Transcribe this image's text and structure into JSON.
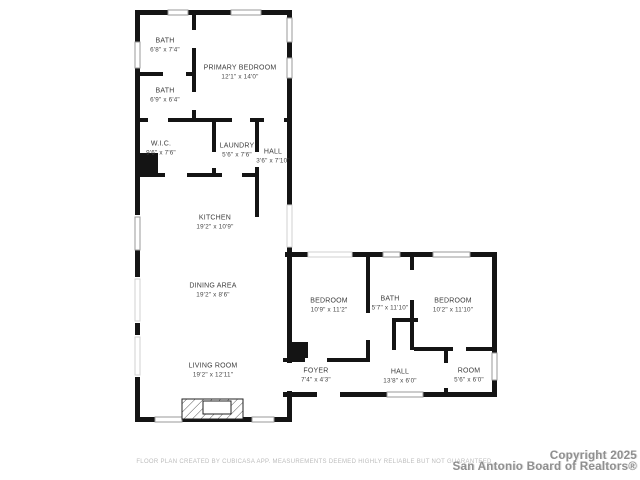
{
  "plan": {
    "source_app": "CubiCasa",
    "colors": {
      "wall": "#141414",
      "window_frame": "#9a9a9a",
      "room_label": "#3c3c3c",
      "disclaimer": "#bcbcbc",
      "copyright": "#8f8f8f",
      "background": "#ffffff"
    },
    "rooms": [
      {
        "id": "bath-upper",
        "name": "BATH",
        "dims": "6'8\" x 7'4\""
      },
      {
        "id": "primary-bedroom",
        "name": "PRIMARY BEDROOM",
        "dims": "12'1\" x 14'0\""
      },
      {
        "id": "bath-lower",
        "name": "BATH",
        "dims": "6'9\" x 6'4\""
      },
      {
        "id": "wic",
        "name": "W.I.C.",
        "dims": "9'6\" x 7'6\""
      },
      {
        "id": "laundry",
        "name": "LAUNDRY",
        "dims": "5'6\" x 7'6\""
      },
      {
        "id": "hall-upper",
        "name": "HALL",
        "dims": "3'6\" x 7'10\""
      },
      {
        "id": "kitchen",
        "name": "KITCHEN",
        "dims": "19'2\" x 10'9\""
      },
      {
        "id": "dining-area",
        "name": "DINING AREA",
        "dims": "19'2\" x 8'6\""
      },
      {
        "id": "living-room",
        "name": "LIVING ROOM",
        "dims": "19'2\" x 12'11\""
      },
      {
        "id": "bedroom-left",
        "name": "BEDROOM",
        "dims": "10'9\" x 11'2\""
      },
      {
        "id": "bath-right",
        "name": "BATH",
        "dims": "5'7\" x 11'10\""
      },
      {
        "id": "bedroom-right",
        "name": "BEDROOM",
        "dims": "10'2\" x 11'10\""
      },
      {
        "id": "foyer",
        "name": "FOYER",
        "dims": "7'4\" x 4'3\""
      },
      {
        "id": "hall-lower",
        "name": "HALL",
        "dims": "13'8\" x 6'0\""
      },
      {
        "id": "room",
        "name": "ROOM",
        "dims": "5'6\" x 6'0\""
      }
    ],
    "footer": {
      "disclaimer": "FLOOR PLAN CREATED BY CUBICASA APP. MEASUREMENTS DEEMED HIGHLY RELIABLE BUT NOT GUARANTEED",
      "copyright_line1": "Copyright 2025",
      "copyright_line2": "San Antonio Board of Realtors®"
    }
  }
}
